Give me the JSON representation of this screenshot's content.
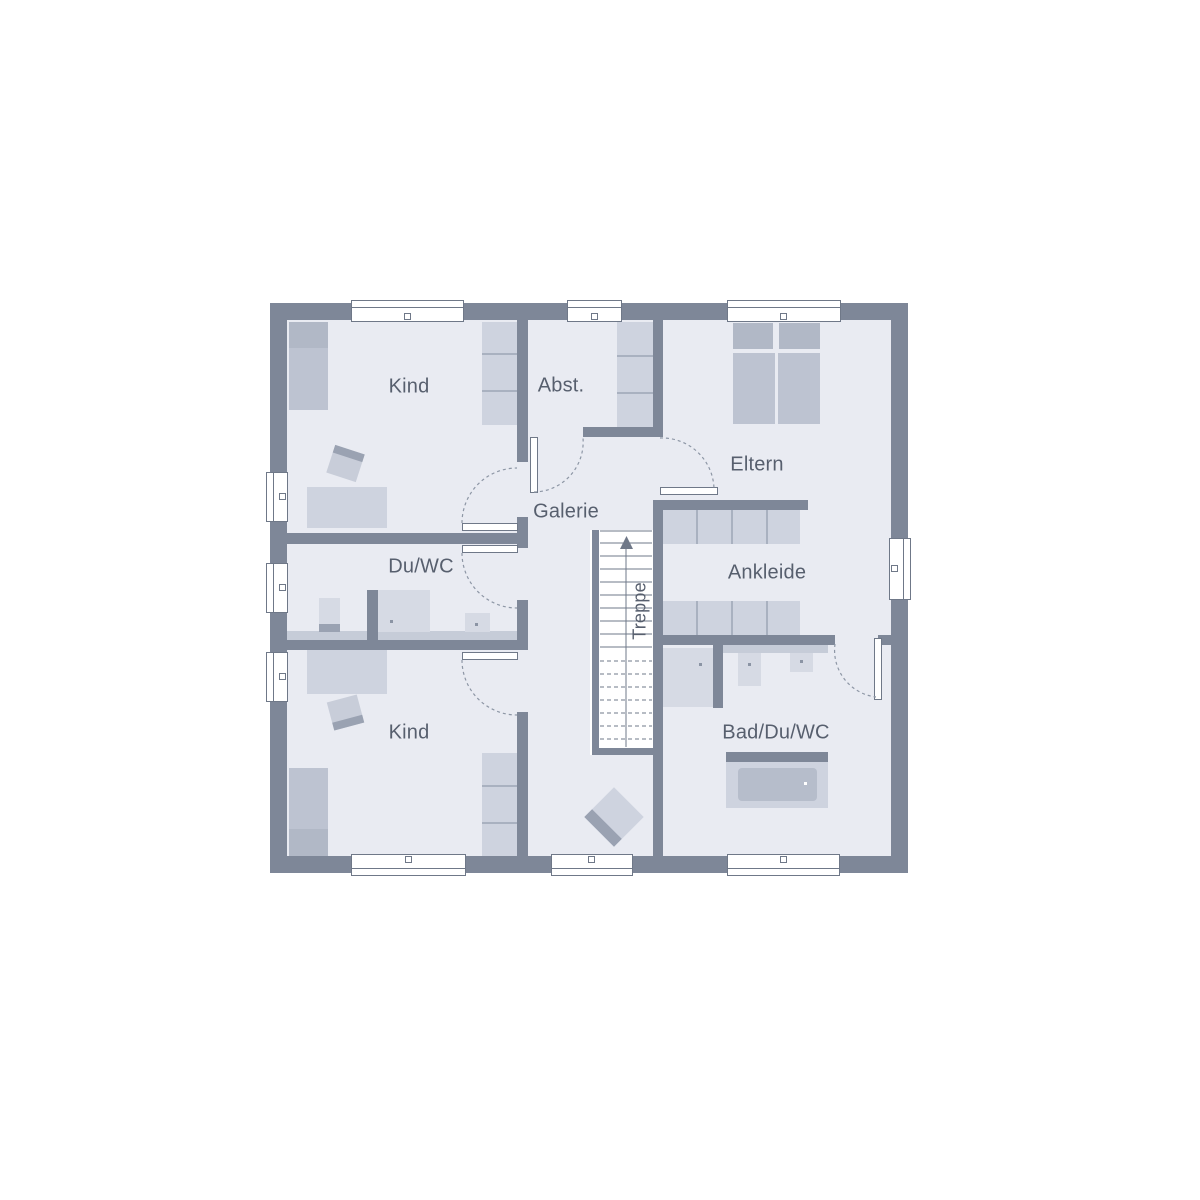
{
  "plan": {
    "title": "Obergeschoss Grundriss",
    "rooms": {
      "kind_top": {
        "label": "Kind"
      },
      "abst": {
        "label": "Abst."
      },
      "eltern": {
        "label": "Eltern"
      },
      "galerie": {
        "label": "Galerie"
      },
      "du_wc": {
        "label": "Du/WC"
      },
      "ankleide": {
        "label": "Ankleide"
      },
      "treppe": {
        "label": "Treppe"
      },
      "kind_bottom": {
        "label": "Kind"
      },
      "bad_du_wc": {
        "label": "Bad/Du/WC"
      }
    },
    "colors": {
      "background": "#ffffff",
      "wall": "#7e8798",
      "floor": "#e9ebf2",
      "line": "#6f7888",
      "arc": "#8d96a5",
      "label_text": "#575f6e",
      "furniture_light": "#ced3df",
      "furniture_medium": "#bdc3d1",
      "furniture_dark": "#b1b8c6",
      "fixture": "#d6dae4",
      "counter": "#c6ccd8",
      "tub_inner": "#b6bdcb",
      "accent_dark": "#9aa2b2",
      "divider": "#a9b1c0",
      "dot": "#8b94a4"
    }
  }
}
